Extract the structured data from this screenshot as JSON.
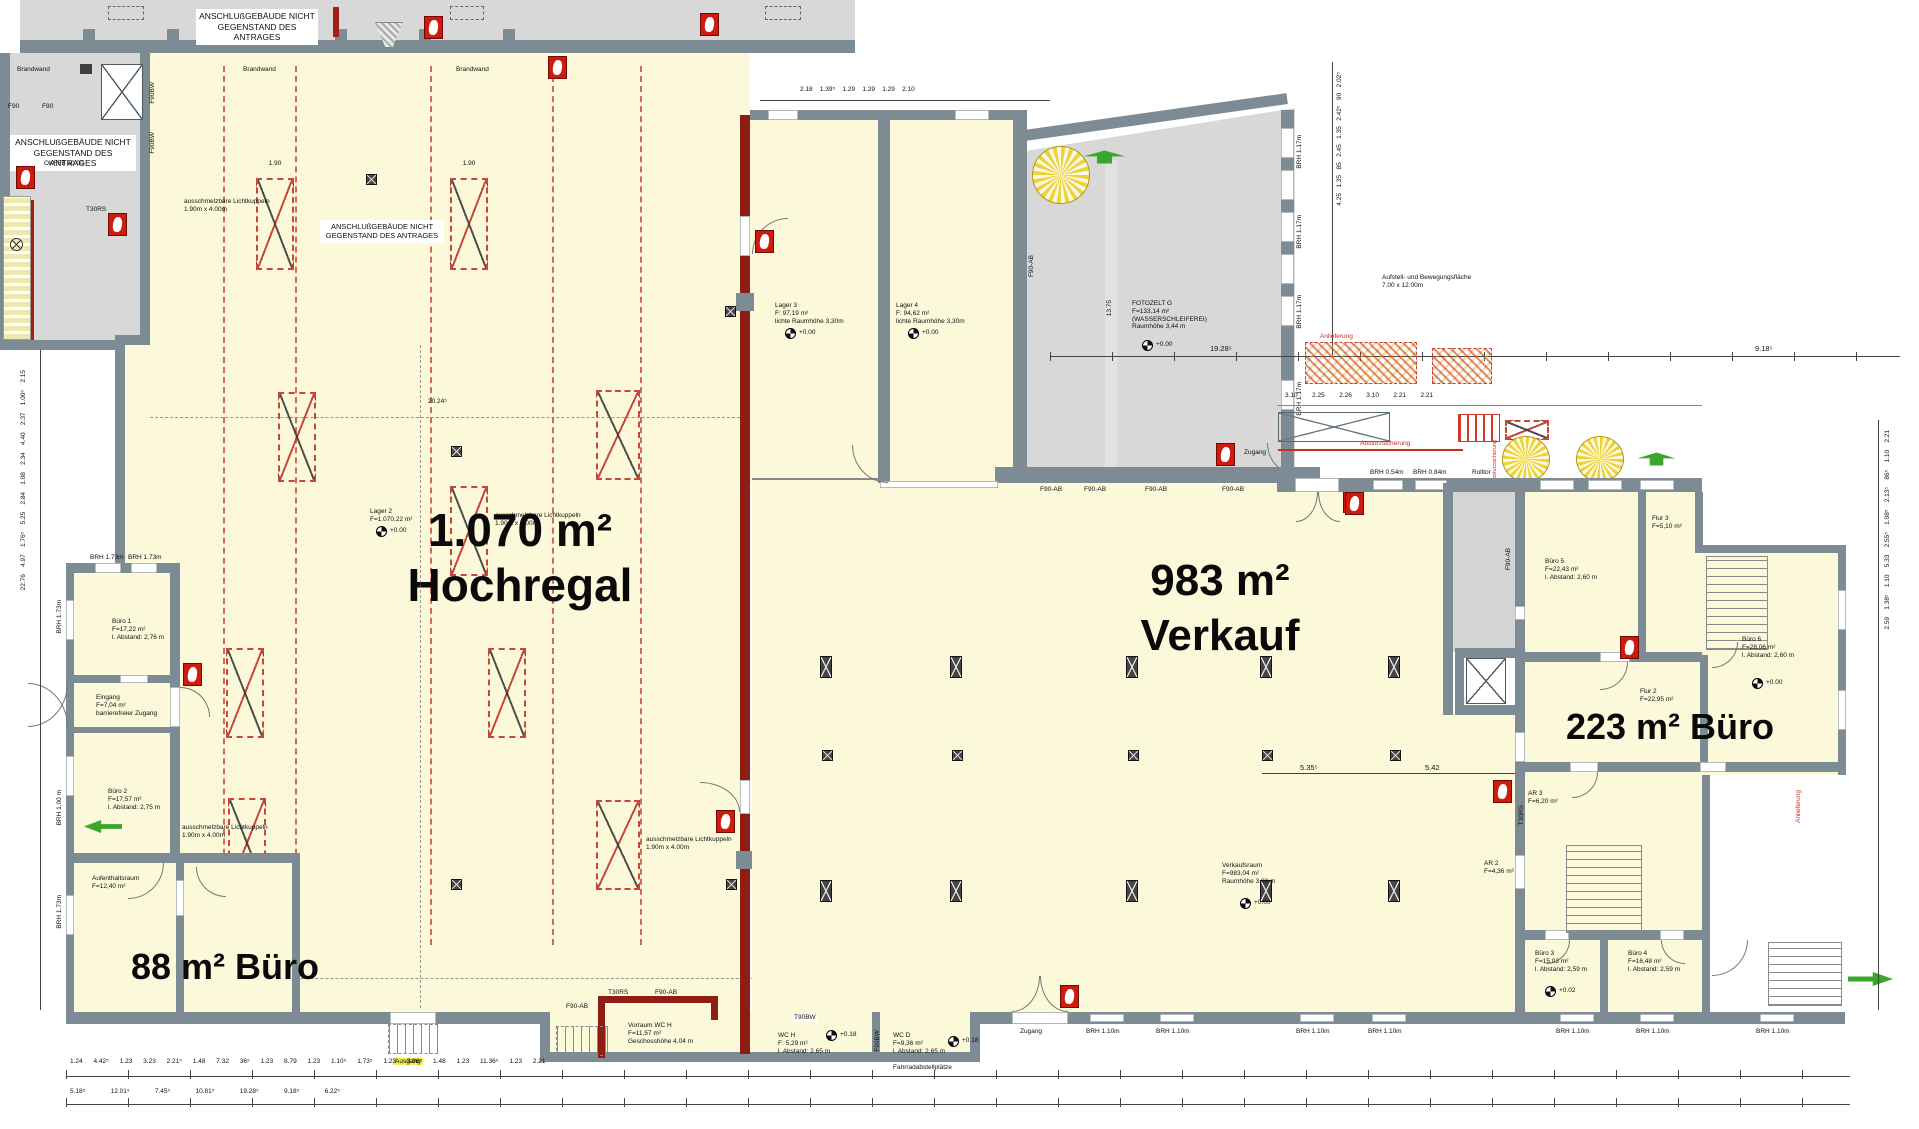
{
  "annotations": {
    "nis_line1": "ANSCHLUßGEBÄUDE NICHT",
    "nis_line2": "GEGENSTAND DES ANTRAGES",
    "brandwand": "Brandwand",
    "lk_line1": "ausschmelzbare Lichtkuppeln",
    "lk_line2": "1.90m x 4.00m",
    "absturzsicherung": "Absturzsicherung",
    "aufstell_line1": "Aufstell- und Bewegungsfläche",
    "aufstell_line2": "7.00 x 12.00m",
    "anlieferung": "Anlieferung",
    "zugang": "Zugang",
    "rolltor": "Rolltor",
    "ausgang": "Ausgang",
    "fahrrad": "Fahrradabstellplätze",
    "okffb": "OKFFB ±0.00"
  },
  "areas": {
    "hochregal_value": "1.070 m²",
    "hochregal_name": "Hochregal",
    "verkauf_value": "983 m²",
    "verkauf_name": "Verkauf",
    "buero_right": "223 m² Büro",
    "buero_left": "88 m² Büro"
  },
  "rooms": {
    "lager2": {
      "l1": "Lager 2",
      "l2": "F=1.070,22 m²"
    },
    "lager3": {
      "l1": "Lager 3",
      "l2": "F: 97,19 m²",
      "l3": "lichte Raumhöhe 3,30m"
    },
    "lager4": {
      "l1": "Lager 4",
      "l2": "F: 94,62 m²",
      "l3": "lichte Raumhöhe 3,30m"
    },
    "fotozelt": {
      "l1": "FOTOZELT G",
      "l2": "F=133,14 m²",
      "l3": "(WASSERSCHLEIFEREI)",
      "l4": "Raumhöhe 3,44 m"
    },
    "verkauf": {
      "l1": "Verkaufsraum",
      "l2": "F=983,04 m²",
      "l3": "Raumhöhe 3,00 m"
    },
    "buero1": {
      "l1": "Büro 1",
      "l2": "F=17,22 m²",
      "l3": "l. Abstand: 2,76 m"
    },
    "eingang": {
      "l1": "Eingang",
      "l2": "F=7,04 m²",
      "l3": "barrierefreier Zugang"
    },
    "buero2": {
      "l1": "Büro 2",
      "l2": "F=17,57 m²",
      "l3": "l. Abstand: 2,75 m"
    },
    "aufenthalt": {
      "l1": "Aufenthaltsraum",
      "l2": "F=12,40 m²"
    },
    "vorraum": {
      "l1": "Vorraum WC H",
      "l2": "F=11,57 m²",
      "l3": "Geschosshöhe 4,04 m"
    },
    "wch": {
      "l1": "WC H",
      "l2": "F: 5,29 m²",
      "l3": "l. Abstand: 2,65 m"
    },
    "wcd": {
      "l1": "WC D",
      "l2": "F=9,36 m²",
      "l3": "l. Abstand: 2,65 m"
    },
    "buero5": {
      "l1": "Büro 5",
      "l2": "F=22,43 m²",
      "l3": "l. Abstand: 2,60 m"
    },
    "buero6": {
      "l1": "Büro 6",
      "l2": "F=28,06 m²",
      "l3": "l. Abstand: 2,60 m"
    },
    "flur2": {
      "l1": "Flur 2",
      "l2": "F=22,95 m²"
    },
    "flur3": {
      "l1": "Flur 3",
      "l2": "F=5,10 m²"
    },
    "ar2": {
      "l1": "AR 2",
      "l2": "F=4,36 m²"
    },
    "ar3": {
      "l1": "AR 3",
      "l2": "F=6,20 m²"
    },
    "buero3": {
      "l1": "Büro 3",
      "l2": "F=15,03 m²",
      "l3": "l. Abstand: 2,59 m"
    },
    "buero4": {
      "l1": "Büro 4",
      "l2": "F=16,48 m²",
      "l3": "l. Abstand: 2,59 m"
    }
  },
  "walls": {
    "f90ab": "F90-AB",
    "f90bw": "F90BW",
    "t30rs": "T30RS",
    "t90bw": "T90BW",
    "f90": "F90"
  },
  "windows": {
    "brh054": "BRH 0.54m",
    "brh084": "BRH 0.84m",
    "brh089": "BRH 0.89m",
    "brh100": "BRH 1.00 m",
    "brh110": "BRH 1.10m",
    "brh117": "BRH 1.17m",
    "brh173": "BRH 1.73m"
  },
  "levels": {
    "zero": "+0.00",
    "p018": "+0.18",
    "p002": "+0.02"
  },
  "dims": {
    "d190": "1.90",
    "d2024": "20.24⁵",
    "d1375": "13.75",
    "walkway_row": "3.10        2.25        2.26        3.10        2.21        2.21",
    "top_mid_row": "2.18    1.39⁵    1.29    1.29    1.29    2.10",
    "d1928": "19.28⁵",
    "d918": "9.18⁵",
    "d535": "5.35⁵",
    "d542": "5.42",
    "left_chain": "22.76    4.97    1.76⁵    5.25    2.84    1.08    2.34    4.40    2.37    1.00⁵    2.15",
    "right_chain": "2.59    1.38⁵    1.10    5.33    2.55⁵    1.08⁵    2.13⁵    86⁵    1.10    2.21",
    "mid_vert_chain": "4.25   1.35   85   2.45   1.35   2.42⁵   90   2.02⁵",
    "bottom_row1": "1.24      4.42⁵      1.23      3.23      2.21⁵      1.48      7.32      36⁵      1.23      8.79      1.23      1.10⁵      1.73⁵      1.23      3.96⁵      1.48      1.23      11.36⁵      1.23      2.21",
    "bottom_row2": "5.18⁵              12.01⁵              7.45⁵              10.81⁵              19.28⁵              9.18⁵              6.22⁵"
  },
  "icons": {
    "fire_extinguisher": "red square fire-extinguisher pictogram",
    "level_mark": "half-filled circular survey marker",
    "exit_arrow": "green escape-route arrow",
    "column": "dark crossed square column marker",
    "light_dome": "red dashed rectangle with X (Lichtkuppel)",
    "spiral_stair": "circular spiral stair",
    "washer": "circled X fixture symbol"
  },
  "colors": {
    "wall": "#7d8b95",
    "fire_wall": "#8e1d13",
    "floor_in_scope": "#fbf9d9",
    "floor_out_scope": "#d8d8d8",
    "accent_red": "#c8473a",
    "exit_green": "#3aa62c",
    "highlight": "#f5ec4f"
  }
}
